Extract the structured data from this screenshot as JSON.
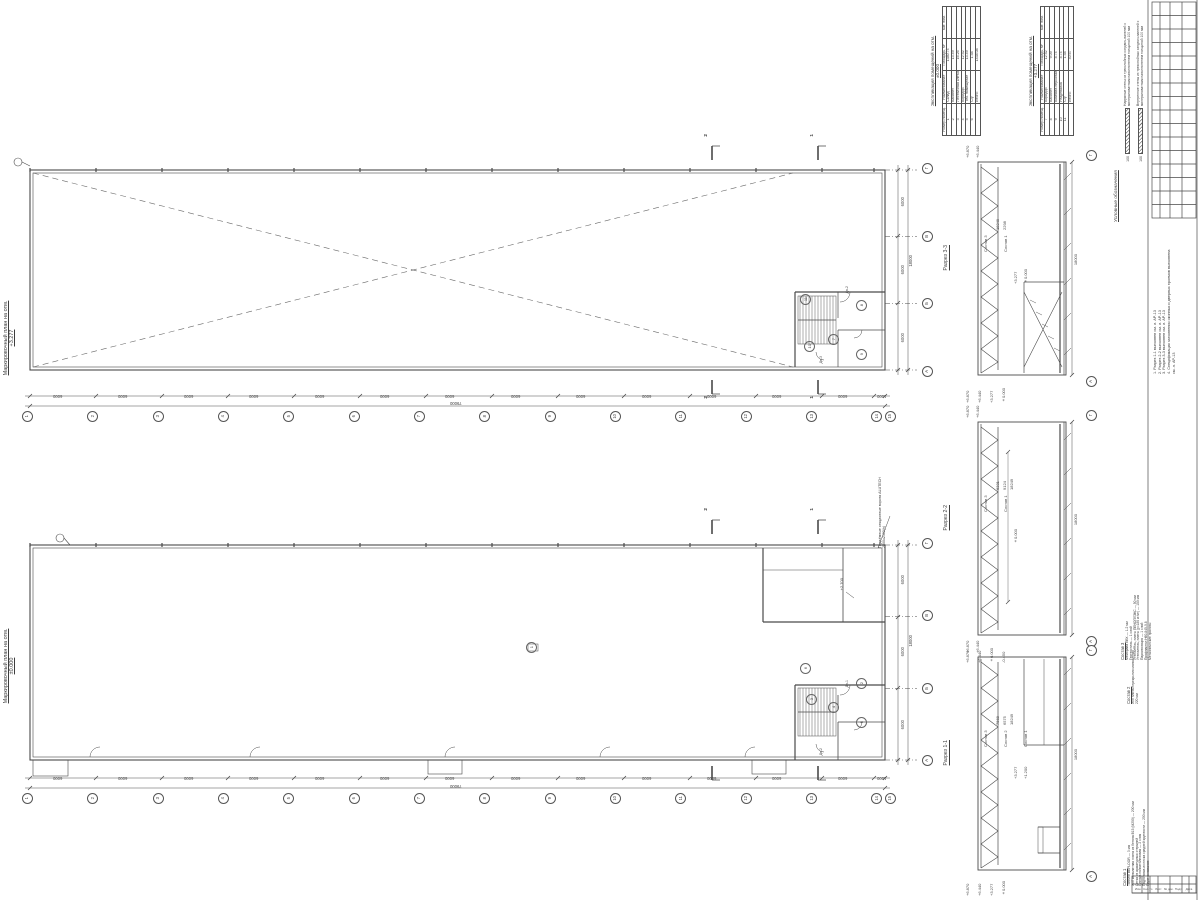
{
  "sheet": {
    "bg": "#ffffff",
    "ink": "#3d3d3d",
    "line": "#4a4a4a"
  },
  "plan_upper": {
    "title": "Маркировочный план на отм.",
    "level": "+3.277",
    "room_numbers": [
      "7",
      "8",
      "9",
      "10",
      "11"
    ],
    "section_marks": {
      "left": "2",
      "right": "1"
    },
    "door_tags": [
      "Дв-2",
      "Дв-3"
    ]
  },
  "plan_lower": {
    "title": "Маркировочный план на отм.",
    "level": "±0.000",
    "room_numbers": [
      "1",
      "2",
      "3",
      "4",
      "5",
      "6"
    ],
    "section_marks": {
      "left": "2",
      "right": "1"
    },
    "gate_note": "Подъёмные секционные ворота ALUTECH 2500х2400(h)",
    "level_note": "+2.700",
    "door_tags": [
      "Дв-1",
      "Дв-2"
    ]
  },
  "grid": {
    "cols": [
      "1",
      "2",
      "3",
      "4",
      "5",
      "6",
      "7",
      "8",
      "9",
      "10",
      "11",
      "12",
      "13",
      "14",
      "15"
    ],
    "col_dims": [
      "6000",
      "6000",
      "6000",
      "6000",
      "6000",
      "6000",
      "6000",
      "6000",
      "6000",
      "6000",
      "6000",
      "6000",
      "6000",
      "1000"
    ],
    "col_total": "79000",
    "rows": [
      "Г",
      "В",
      "Б",
      "А"
    ],
    "row_dims": [
      "6000",
      "6000",
      "6000"
    ],
    "row_total": "18000"
  },
  "sections": [
    {
      "label": "Разрез 3-3",
      "grid_top": "Г",
      "grid_bottom": "А",
      "elevations_top": [
        "+6.870",
        "+6.440"
      ],
      "elevations_bottom": [
        "+6.870",
        "+6.440",
        "+3.277",
        "±0.000"
      ],
      "elevations_mid": [
        "+3.277",
        "±0.000"
      ],
      "dims": [
        "18249",
        "2298"
      ],
      "dim_total": "18000",
      "comp_refs": [
        "Состав 3",
        "Состав 1"
      ]
    },
    {
      "label": "Разрез 2-2",
      "grid_top": "Г",
      "grid_bottom": "А",
      "elevations_top": [
        "+6.870",
        "+6.440"
      ],
      "elevations_bottom": [
        "+6.870",
        "+6.440",
        "±0.000",
        "-0.450"
      ],
      "elevations_mid": [
        "±0.000"
      ],
      "dims": [
        "6331",
        "9124",
        "18249"
      ],
      "dim_total": "18000",
      "comp_refs": [
        "Состав 3",
        "Состав 1"
      ]
    },
    {
      "label": "Разрез 1-1",
      "grid_top": "Г",
      "grid_bottom": "А",
      "elevations_top": [
        "+6.870",
        "+6.440"
      ],
      "elevations_bottom": [
        "+6.870",
        "+6.440",
        "+3.277",
        "±0.000"
      ],
      "elevations_mid": [
        "+3.277",
        "+1.200"
      ],
      "dims": [
        "7568",
        "6575",
        "18249"
      ],
      "dim_total": "18000",
      "comp_refs": [
        "Состав 3",
        "Состав 2",
        "Состав 1"
      ]
    }
  ],
  "tables": [
    {
      "title": "Экспликация помещений на отм.",
      "level": "±0.000",
      "headers": [
        "Номер помещ.",
        "Наименование",
        "Площадь, м²",
        "Кат. пом."
      ],
      "rows": [
        [
          "1",
          "Склад",
          "1380.74",
          ""
        ],
        [
          "2",
          "Кабинет",
          "13.49",
          ""
        ],
        [
          "3",
          "Лестничная клетка",
          "16.26",
          ""
        ],
        [
          "4",
          "Коридор",
          "12.52",
          ""
        ],
        [
          "5",
          "Тех. помещение",
          "13.49",
          ""
        ],
        [
          "6",
          "С/у",
          "1.58",
          ""
        ]
      ],
      "total_label": "Итого:",
      "total": "1438.08"
    },
    {
      "title": "Экспликация помещений на отм.",
      "level": "+3.277",
      "headers": [
        "Номер помещ.",
        "Наименование",
        "Площадь, м²",
        "Кат. пом."
      ],
      "rows": [
        [
          "7",
          "Коридор",
          "12.52",
          ""
        ],
        [
          "8",
          "Кабинет",
          "9.09",
          ""
        ],
        [
          "9",
          "Комната персонала",
          "8.74",
          ""
        ],
        [
          "10",
          "Раздевалка",
          "8.74",
          ""
        ],
        [
          "11",
          "С/у",
          "1.58",
          ""
        ]
      ],
      "total_label": "Итого:",
      "total": "40.67"
    }
  ],
  "legend": {
    "title": "Условные обозначения",
    "items": [
      {
        "dim": "100",
        "text": "Наружные стены из трехслойных сэндвич-панелей с минераловатным наполнителем толщиной 100 мм"
      },
      {
        "dim": "100",
        "text": "Внутренние стены из трехслойных сэндвич-панелей с минераловатным наполнителем толщиной 100 мм"
      }
    ]
  },
  "notes": [
    "1. Разрез 1-1 выполнен см. л. АР-13",
    "2. Разрез 2-2 выполнен см. л. АР-13",
    "3. Разрез 3-3 выполнен см. л. АР-13",
    "4. Спецификация заполнения оконных и дверных проемов выполнена см. л. АР-13"
  ],
  "compositions": [
    {
      "title": "Состав 3",
      "items": [
        "Мембрана ПВХ — 1.2 мм",
        "Геотекстиль — 1 слой",
        "Утеплитель, плиты ПЕНОПЛЭКС — 50 мм",
        "Утеплитель, плиты (γ=180 кг/м³) — 150 мм",
        "Пароизоляция — 1 слой",
        "Профнастил Н60-845-0.8",
        "Металлические прогоны"
      ]
    },
    {
      "title": "Состав 2",
      "items": [
        "Ж/б плита перекрытия монолитная — 220 мм"
      ]
    },
    {
      "title": "Состав 1",
      "items": [
        "Топпинг BEFLOOR — 3 мм",
        "Ж/б монолитная плита из бетона В15 (М200) — 200 мм",
        "Сетка из арматурных стержней",
        "Пленка полиэтиленовая — 2 слоя",
        "Подготовка из песка средней крупности — 200 мм",
        "Грунт основания"
      ]
    }
  ],
  "title_block": {
    "columns": [
      "Изм.",
      "Кол.уч.",
      "Лист",
      "№ док.",
      "Подп.",
      "Дата"
    ]
  }
}
